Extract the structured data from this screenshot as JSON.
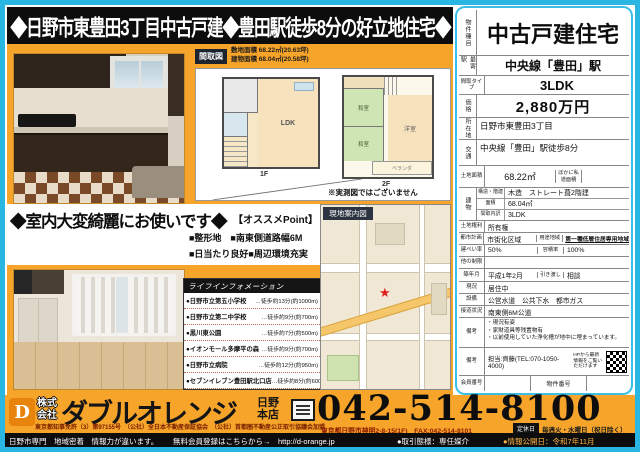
{
  "colors": {
    "accent_cyan": "#2ab6e2",
    "orange": "#f6a42a",
    "black": "#0d0d0d",
    "dark_red": "#7a2000",
    "logo_orange": "#e8830c"
  },
  "banner": {
    "title": "◆日野市東豊田3丁目中古戸建◆豊田駅徒歩8分の好立地住宅◆"
  },
  "floorplan": {
    "tag": "間取図",
    "site_area": "敷地面積 68.22㎡(20.63坪)",
    "building_area": "建物面積 68.04㎡(20.58坪)",
    "floor1": "1F",
    "floor2": "2F",
    "room_ldk": "LDK",
    "room_washitsu1": "和室",
    "room_washitsu2": "和室",
    "room_youshitsu": "洋室",
    "balcony": "ベランダ",
    "note": "※実測図ではございません"
  },
  "appeal": {
    "headline": "◆室内大変綺麗にお使いです◆",
    "points_title": "【オススメPoint】",
    "point1": "■整形地　■南東側道路幅6M",
    "point2": "■日当たり良好■周辺環境充実"
  },
  "life_info": {
    "title": "ライフインフォメーション",
    "items": [
      {
        "name": "●日野市立第五小学校",
        "dist": "…徒歩約13分(約1000m)"
      },
      {
        "name": "●日野市立第二中学校",
        "dist": "…徒歩約9分(約700m)"
      },
      {
        "name": "●黒川東公園",
        "dist": "…徒歩約7分(約500m)"
      },
      {
        "name": "●イオンモール多摩平の森",
        "dist": "…徒歩約9分(約700m)"
      },
      {
        "name": "●日野市立病院",
        "dist": "…徒歩約12分(約950m)"
      },
      {
        "name": "●セブンイレブン豊田駅北口店",
        "dist": "…徒歩約8分(約600m)"
      }
    ]
  },
  "map": {
    "label": "現地案内図"
  },
  "spec": {
    "property_type_label": "物件種目",
    "property_type": "中古戸建住宅",
    "station_label": "最寄駅",
    "station": "中央線「豊田」駅",
    "layout_label": "間取タイプ",
    "layout": "3LDK",
    "price_label": "価格",
    "price": "2,880万円",
    "location_label": "所在地",
    "location": "日野市東豊田3丁目",
    "access_label": "交通",
    "access": "中央線「豊田」駅徒歩8分",
    "land_label": "土地面積",
    "land_area": "68.22㎡",
    "private_road_label": "ほかに私道面積",
    "building_label": "建物",
    "structure_label": "構造・階建",
    "structure": "木造　ストレート葺2階建",
    "barea_label": "面積",
    "barea": "68.04㎡",
    "rooms_label": "間取内訳",
    "rooms": "3LDK",
    "rights_label": "土地権利",
    "rights": "所有権",
    "planning_label": "都市計画",
    "planning": "市街化区域",
    "zone_label": "用途地域",
    "zone": "第一種低層住居専用地域",
    "coverage_label": "建ぺい率",
    "coverage": "50%",
    "far_label": "容積率",
    "far": "100%",
    "other_label": "他の制限",
    "built_label": "築年月",
    "built": "平成1年2月",
    "handover_label": "引き渡し",
    "handover": "相談",
    "status_label": "現況",
    "status": "居住中",
    "utilities_label": "設備",
    "utilities": "公営水道　公共下水　都市ガス",
    "road_label": "接道状況",
    "road": "南東側6M公道",
    "remarks_label": "備考",
    "remarks": [
      "・現況有姿",
      "・家財道具等残置物有",
      "・以前使用していた浄化槽が地中に埋まっています。"
    ],
    "remarks2_label": "備考",
    "contact": "担当:齊藤(TEL:070-1050-4000)",
    "hp_note": "HPから最新情報をご覧いただけます",
    "member_label": "会員番号",
    "bukken_label": "物件番号"
  },
  "footer": {
    "logo_letter": "D",
    "company_prefix": "株式\n会社",
    "company": "ダブルオレンジ",
    "branch": "日野\n本店",
    "license": "東京都知事免許（3）第97155号　（公社）全日本不動産保証協会　（公社）首都圏不動産公正取引協議会加盟",
    "phone": "042-514-8100",
    "address": "東京都日野市神明2-8-15(1F)　FAX:042-514-8101",
    "holiday_label": "定休日",
    "holiday": "毎週火・水曜日（祝日除く）",
    "strip_left": "日野市専門　地域密着　情報力が違います。",
    "strip_mid": "無料会員登録はこちらから→　http://d-orange.jp",
    "deal_type": "●取引態様：専任媒介",
    "published": "●情報公開日：令和7年11月"
  }
}
